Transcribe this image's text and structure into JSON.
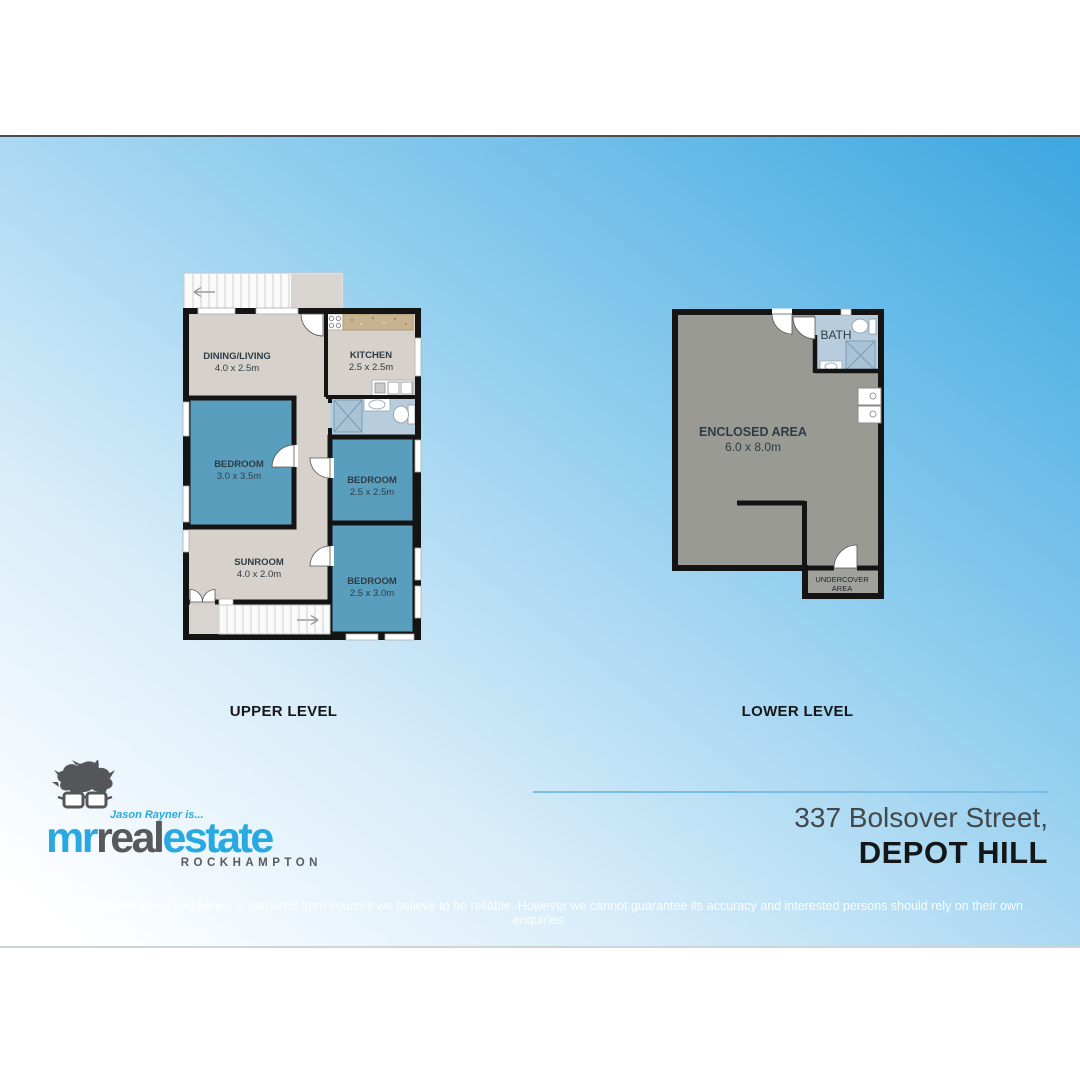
{
  "levels": {
    "upper": "UPPER LEVEL",
    "lower": "LOWER LEVEL"
  },
  "upper_plan": {
    "dining": {
      "name": "DINING/LIVING",
      "dims": "4.0 x 2.5m"
    },
    "kitchen": {
      "name": "KITCHEN",
      "dims": "2.5 x 2.5m"
    },
    "bedroom1": {
      "name": "BEDROOM",
      "dims": "3.0 x 3.5m"
    },
    "bedroom2": {
      "name": "BEDROOM",
      "dims": "2.5 x 2.5m"
    },
    "sunroom": {
      "name": "SUNROOM",
      "dims": "4.0 x 2.0m"
    },
    "bedroom3": {
      "name": "BEDROOM",
      "dims": "2.5 x 3.0m"
    }
  },
  "lower_plan": {
    "enclosed": {
      "name": "ENCLOSED AREA",
      "dims": "6.0 x 8.0m"
    },
    "bath": {
      "name": "BATH"
    },
    "undercover": {
      "line1": "UNDERCOVER",
      "line2": "AREA"
    }
  },
  "branding": {
    "tagline": "Jason Rayner is...",
    "mr": "mr",
    "real": "real",
    "estate": "estate",
    "region": "ROCKHAMPTON"
  },
  "address": {
    "street": "337 Bolsover Street,",
    "suburb": "DEPOT HILL"
  },
  "disclaimer": "All information contained herein is gathered from sources we believe to be reliable. However we cannot guarantee its accuracy and interested persons should rely on their own enquiries.",
  "plan_icons": [
    "stairs-up-icon",
    "stairs-down-icon",
    "stove-icon",
    "kitchen-bench-icon",
    "sink-icon",
    "shower-icon",
    "toilet-icon",
    "vanity-icon",
    "laundry-tubs-icon",
    "door-swing-icon",
    "double-door-icon",
    "window-icon"
  ],
  "colors": {
    "accent_blue": "#29a9e1",
    "canvas_blue": "#3ca7e0",
    "room_blue": "#5a9ebe",
    "floor_beige": "#d6d2cb",
    "floor_gray": "#9a9a95",
    "bath_blue": "#b7cddd",
    "wall_black": "#141414"
  }
}
